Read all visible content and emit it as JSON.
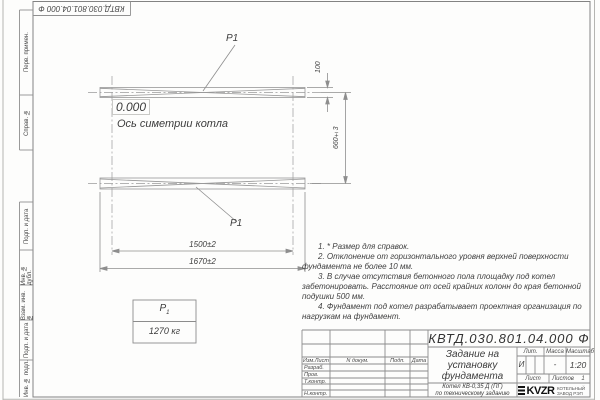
{
  "doc_number": "КВТД.030.801.04.000 Ф",
  "stamp_strip": {
    "top_rotated_number": "КВТД.030.801.04.000 Ф",
    "cells": [
      "Перв. примен.",
      "Справ. №",
      "Подп. и дата",
      "Инв. № дубл.",
      "Взам. инв. №",
      "Подп. и дата",
      "Инв. № подл."
    ]
  },
  "drawing": {
    "level_mark": "0.000",
    "symmetry_axis_label": "Ось симетрии котла",
    "load_point_top": "Р1",
    "load_point_bottom": "Р1",
    "dims": {
      "beam_width": "100",
      "beam_spacing": "660±3",
      "inner_span": "1500±2",
      "outer_span": "1670±2"
    }
  },
  "load_table": {
    "symbol": "Р",
    "symbol_sub": "1",
    "value": "1270 кг"
  },
  "notes": [
    "1. * Размер для справок.",
    "2. Отклонение от горизонтального уровня верхней поверхности фундамента не более 10 мм.",
    "3. В случае отсутствия бетонного пола площадку под котел забетонировать. Расстояние от осей крайних колонн до края бетонной подушки 500 мм.",
    "4. Фундамент под котел разрабатывает проектная организация по нагрузкам на фундамент."
  ],
  "title_block": {
    "doc_number": "КВТД.030.801.04.000 Ф",
    "title": "Задание на установку фундамента",
    "product_line1": "Котел КВ-0,35 Д (ПГ)",
    "product_line2": "по техническому заданию",
    "change_cols": {
      "col1": "Изм.Лист",
      "col2": "N докум.",
      "col3": "Подп.",
      "col4": "Дата"
    },
    "roles": {
      "developed": "Разраб.",
      "checked": "Пров.",
      "tcontrol": "Т.контр.",
      "ncontrol": "Н.контр."
    },
    "lit_label": "Лит.",
    "lit_value": "И",
    "mass_label": "Масса",
    "mass_value": "-",
    "scale_label": "Масштаб",
    "scale_value": "1:20",
    "sheet_label": "Лист",
    "sheets_label": "Листов",
    "sheets_value": "1",
    "logo": {
      "text": "KVZR",
      "caption_line1": "КОТЕЛЬНЫЙ",
      "caption_line2": "ЗАВОД РЭП"
    }
  }
}
